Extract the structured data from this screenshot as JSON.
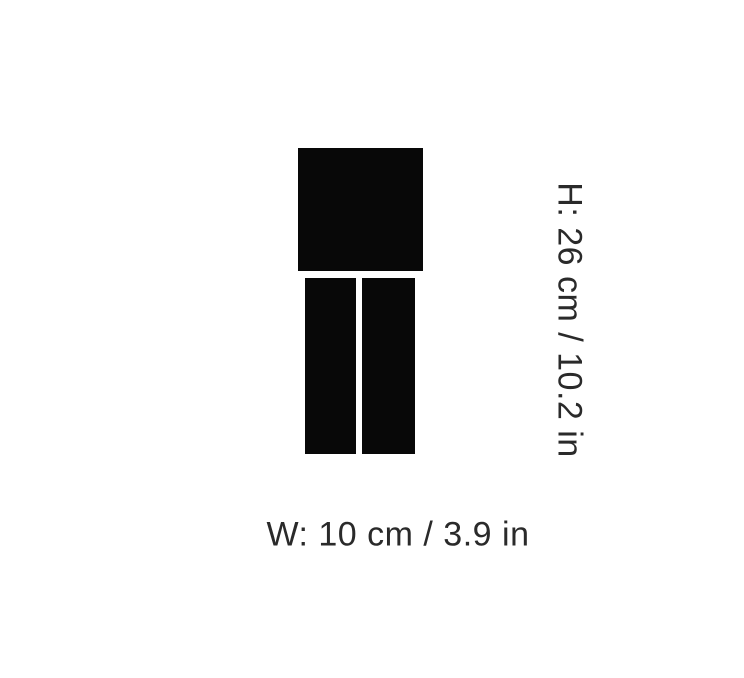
{
  "colors": {
    "background": "#ffffff",
    "shape": "#080808",
    "text": "#2a2a2a"
  },
  "product_diagram": {
    "height_label": "H: 26 cm / 10.2 in",
    "width_label": "W: 10 cm / 3.9 in",
    "height_value_cm": 26,
    "height_value_in": 10.2,
    "width_value_cm": 10,
    "width_value_in": 3.9
  }
}
